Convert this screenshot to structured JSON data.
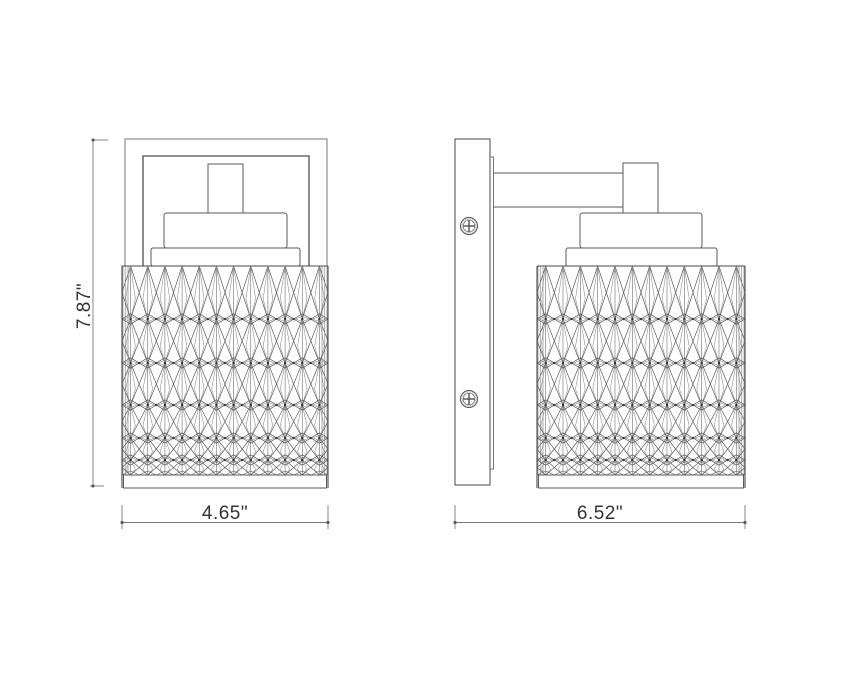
{
  "drawing": {
    "kind": "dimensioned-line-drawing",
    "subject": "crystal cylinder wall sconce, front and side orthographic views",
    "dimensions": {
      "height": "7.87\"",
      "front_width": "4.65\"",
      "side_depth": "6.52\""
    },
    "colors": {
      "background": "#ffffff",
      "object_line": "#5a5a5a",
      "shade_outline": "#4a4a4a",
      "light_line": "#8f8f8f",
      "inner_plate_line": "#6f6f6f",
      "pattern_line": "#5e5e5e",
      "pattern_light": "#8a8a8a",
      "node_dot": "#333333",
      "dimension_line": "#7a7a7a",
      "text": "#333333"
    },
    "icons": {
      "screw": "phillips-screw-icon"
    }
  }
}
